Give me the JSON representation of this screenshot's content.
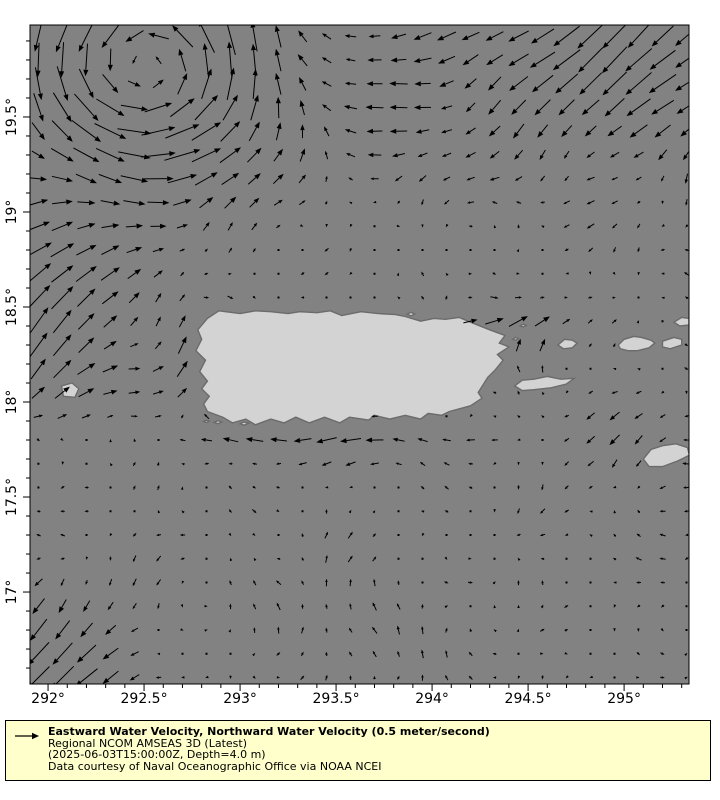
{
  "legend": {
    "title": "Eastward Water Velocity, Northward Water Velocity (0.5 meter/second)",
    "model": "Regional NCOM AMSEAS 3D (Latest)",
    "time_depth": "(2025-06-03T15:00:00Z, Depth=4.0 m)",
    "credit": "Data courtesy of Naval Oceanographic Office via NOAA NCEI"
  },
  "chart_data": {
    "type": "quiver_map",
    "description": "Vector field of eastward/northward water velocity around Puerto Rico and the Virgin Islands",
    "x_axis": {
      "ticks": [
        "292°",
        "292.5°",
        "293°",
        "293.5°",
        "294°",
        "294.5°",
        "295°"
      ],
      "tick_values": [
        292,
        292.5,
        293,
        293.5,
        294,
        294.5,
        295
      ],
      "minor_step": 0.1,
      "range": [
        291.906,
        295.338
      ]
    },
    "y_axis": {
      "ticks": [
        "17°",
        "17.5°",
        "18°",
        "18.5°",
        "19°",
        "19.5°"
      ],
      "tick_values": [
        17,
        17.5,
        18,
        18.5,
        19,
        19.5
      ],
      "minor_step": 0.1,
      "range": [
        16.516,
        19.984
      ]
    },
    "reference_vector": {
      "speed_ms": 0.5,
      "label": "0.5 meter/second"
    },
    "scale_px_per_ms": 46,
    "grid": {
      "lon_start": 291.95,
      "lat_start": 16.55,
      "step": 0.125,
      "nx": 28,
      "ny": 28
    },
    "colors": {
      "ocean": "#828282",
      "land": "#d3d3d3",
      "coastline": "#6b6b6b",
      "arrow": "#000000",
      "axes_border": "#000000",
      "legend_bg": "#ffffcc",
      "figure_bg": "#ffffff"
    },
    "islands": [
      {
        "name": "puerto-rico",
        "mask": true,
        "points": [
          [
            292.89,
            18.48
          ],
          [
            293.0,
            18.465
          ],
          [
            293.08,
            18.48
          ],
          [
            293.16,
            18.475
          ],
          [
            293.25,
            18.465
          ],
          [
            293.31,
            18.475
          ],
          [
            293.4,
            18.47
          ],
          [
            293.47,
            18.48
          ],
          [
            293.53,
            18.455
          ],
          [
            293.63,
            18.475
          ],
          [
            293.72,
            18.465
          ],
          [
            293.81,
            18.46
          ],
          [
            293.86,
            18.45
          ],
          [
            293.94,
            18.425
          ],
          [
            294.01,
            18.44
          ],
          [
            294.07,
            18.435
          ],
          [
            294.14,
            18.445
          ],
          [
            294.2,
            18.42
          ],
          [
            294.3,
            18.38
          ],
          [
            294.38,
            18.35
          ],
          [
            294.35,
            18.31
          ],
          [
            294.4,
            18.29
          ],
          [
            294.34,
            18.25
          ],
          [
            294.37,
            18.22
          ],
          [
            294.33,
            18.17
          ],
          [
            294.29,
            18.13
          ],
          [
            294.24,
            18.05
          ],
          [
            294.26,
            18.02
          ],
          [
            294.2,
            17.98
          ],
          [
            294.09,
            17.95
          ],
          [
            294.05,
            17.93
          ],
          [
            293.98,
            17.94
          ],
          [
            293.94,
            17.91
          ],
          [
            293.86,
            17.93
          ],
          [
            293.78,
            17.91
          ],
          [
            293.7,
            17.93
          ],
          [
            293.67,
            17.905
          ],
          [
            293.57,
            17.92
          ],
          [
            293.52,
            17.89
          ],
          [
            293.44,
            17.92
          ],
          [
            293.36,
            17.89
          ],
          [
            293.29,
            17.92
          ],
          [
            293.23,
            17.89
          ],
          [
            293.16,
            17.91
          ],
          [
            293.08,
            17.88
          ],
          [
            293.03,
            17.91
          ],
          [
            292.96,
            17.89
          ],
          [
            292.91,
            17.92
          ],
          [
            292.83,
            17.95
          ],
          [
            292.81,
            17.99
          ],
          [
            292.84,
            18.03
          ],
          [
            292.8,
            18.07
          ],
          [
            292.83,
            18.11
          ],
          [
            292.79,
            18.16
          ],
          [
            292.82,
            18.22
          ],
          [
            292.77,
            18.27
          ],
          [
            292.8,
            18.33
          ],
          [
            292.78,
            18.38
          ],
          [
            292.83,
            18.44
          ]
        ]
      },
      {
        "name": "vieques",
        "mask": true,
        "points": [
          [
            294.43,
            18.085
          ],
          [
            294.47,
            18.115
          ],
          [
            294.53,
            18.12
          ],
          [
            294.6,
            18.135
          ],
          [
            294.67,
            18.12
          ],
          [
            294.74,
            18.125
          ],
          [
            294.7,
            18.095
          ],
          [
            294.62,
            18.075
          ],
          [
            294.53,
            18.065
          ],
          [
            294.47,
            18.06
          ]
        ]
      },
      {
        "name": "culebra",
        "mask": true,
        "points": [
          [
            294.655,
            18.3
          ],
          [
            294.69,
            18.33
          ],
          [
            294.73,
            18.325
          ],
          [
            294.755,
            18.31
          ],
          [
            294.73,
            18.285
          ],
          [
            294.685,
            18.28
          ]
        ]
      },
      {
        "name": "mona",
        "mask": true,
        "points": [
          [
            292.07,
            18.085
          ],
          [
            292.125,
            18.1
          ],
          [
            292.16,
            18.07
          ],
          [
            292.14,
            18.025
          ],
          [
            292.08,
            18.03
          ]
        ]
      },
      {
        "name": "st-thomas",
        "mask": true,
        "points": [
          [
            294.97,
            18.3
          ],
          [
            295.0,
            18.33
          ],
          [
            295.05,
            18.345
          ],
          [
            295.09,
            18.34
          ],
          [
            295.14,
            18.325
          ],
          [
            295.16,
            18.31
          ],
          [
            295.13,
            18.285
          ],
          [
            295.07,
            18.27
          ],
          [
            295.02,
            18.27
          ],
          [
            294.98,
            18.28
          ]
        ]
      },
      {
        "name": "st-john",
        "mask": true,
        "points": [
          [
            295.2,
            18.32
          ],
          [
            295.26,
            18.34
          ],
          [
            295.3,
            18.33
          ],
          [
            295.3,
            18.3
          ],
          [
            295.24,
            18.28
          ],
          [
            295.2,
            18.29
          ]
        ]
      },
      {
        "name": "tortola",
        "mask": true,
        "points": [
          [
            295.26,
            18.42
          ],
          [
            295.3,
            18.445
          ],
          [
            295.338,
            18.44
          ],
          [
            295.338,
            18.405
          ],
          [
            295.29,
            18.4
          ]
        ]
      },
      {
        "name": "st-croix",
        "mask": true,
        "points": [
          [
            295.1,
            17.7
          ],
          [
            295.14,
            17.75
          ],
          [
            295.2,
            17.77
          ],
          [
            295.27,
            17.78
          ],
          [
            295.33,
            17.76
          ],
          [
            295.34,
            17.72
          ],
          [
            295.28,
            17.69
          ],
          [
            295.2,
            17.66
          ],
          [
            295.13,
            17.66
          ]
        ]
      },
      {
        "name": "islet-caja-de-muertos",
        "mask": false,
        "points": [
          [
            293.0,
            17.885
          ],
          [
            293.02,
            17.895
          ],
          [
            293.045,
            17.888
          ],
          [
            293.02,
            17.878
          ]
        ]
      },
      {
        "name": "islet-south-1",
        "mask": false,
        "points": [
          [
            292.865,
            17.893
          ],
          [
            292.885,
            17.902
          ],
          [
            292.905,
            17.895
          ],
          [
            292.885,
            17.886
          ]
        ]
      },
      {
        "name": "islet-south-2",
        "mask": false,
        "points": [
          [
            292.81,
            17.898
          ],
          [
            292.825,
            17.905
          ],
          [
            292.84,
            17.899
          ],
          [
            292.825,
            17.892
          ]
        ]
      },
      {
        "name": "islet-northeast-1",
        "mask": false,
        "points": [
          [
            294.46,
            18.4
          ],
          [
            294.475,
            18.41
          ],
          [
            294.49,
            18.403
          ],
          [
            294.475,
            18.395
          ]
        ]
      },
      {
        "name": "islet-northeast-2",
        "mask": false,
        "points": [
          [
            294.42,
            18.33
          ],
          [
            294.435,
            18.34
          ],
          [
            294.45,
            18.333
          ],
          [
            294.435,
            18.325
          ]
        ]
      },
      {
        "name": "islet-north-coast",
        "mask": false,
        "points": [
          [
            293.87,
            18.462
          ],
          [
            293.89,
            18.472
          ],
          [
            293.91,
            18.463
          ],
          [
            293.89,
            18.453
          ]
        ]
      }
    ],
    "flow_features": [
      {
        "name": "northwest-eddy",
        "type": "vortex",
        "center": [
          292.52,
          19.78
        ],
        "sigma": 0.42,
        "strength": 0.75,
        "rotation": "ccw"
      },
      {
        "name": "north-westward-band",
        "type": "gaussian",
        "center": [
          293.75,
          19.7
        ],
        "sx": 0.45,
        "sy": 0.55,
        "u": -0.32,
        "v": -0.02
      },
      {
        "name": "northeast-southwest-flow",
        "type": "gaussian",
        "center": [
          295.0,
          19.85
        ],
        "sx": 0.9,
        "sy": 0.6,
        "u": -0.55,
        "v": -0.48
      },
      {
        "name": "mona-passage-ne-jet",
        "type": "gaussian",
        "center": [
          291.9,
          18.55
        ],
        "sx": 0.45,
        "sy": 0.5,
        "u": 0.55,
        "v": 0.6
      },
      {
        "name": "mona-eastward-flow",
        "type": "gaussian",
        "center": [
          292.45,
          18.1
        ],
        "sx": 0.35,
        "sy": 0.22,
        "u": 0.3,
        "v": 0.05
      },
      {
        "name": "west-coast-northward",
        "type": "gaussian",
        "center": [
          292.7,
          18.25
        ],
        "sx": 0.12,
        "sy": 0.28,
        "u": 0.05,
        "v": 0.35
      },
      {
        "name": "south-coast-westward",
        "type": "gaussian",
        "center": [
          293.4,
          17.8
        ],
        "sx": 0.9,
        "sy": 0.13,
        "u": -0.38,
        "v": 0.0
      },
      {
        "name": "southwest-corner-flow",
        "type": "gaussian",
        "center": [
          291.9,
          16.5
        ],
        "sx": 0.55,
        "sy": 0.55,
        "u": -0.5,
        "v": -0.5
      },
      {
        "name": "south-center-north-patch",
        "type": "gaussian",
        "center": [
          293.6,
          16.85
        ],
        "sx": 0.45,
        "sy": 0.35,
        "u": 0.0,
        "v": 0.22
      },
      {
        "name": "east-tip-eastward",
        "type": "gaussian",
        "center": [
          294.35,
          18.43
        ],
        "sx": 0.3,
        "sy": 0.1,
        "u": 0.4,
        "v": 0.1
      },
      {
        "name": "vieques-north-flow",
        "type": "gaussian",
        "center": [
          294.52,
          18.33
        ],
        "sx": 0.18,
        "sy": 0.18,
        "u": 0.15,
        "v": 0.35
      },
      {
        "name": "east-south-drift",
        "type": "gaussian",
        "center": [
          294.9,
          17.8
        ],
        "sx": 0.45,
        "sy": 0.3,
        "u": -0.12,
        "v": -0.12
      },
      {
        "name": "right-mid-westward",
        "type": "gaussian",
        "center": [
          295.2,
          17.5
        ],
        "sx": 0.3,
        "sy": 0.3,
        "u": -0.15,
        "v": 0.0
      }
    ],
    "noise": {
      "terms": [
        {
          "target": "u",
          "amp": 0.055,
          "a": 3.1,
          "b": 7.3,
          "phase": 2.0
        },
        {
          "target": "u",
          "amp": 0.045,
          "a": 9.7,
          "b": -5.1,
          "phase": 0.0
        },
        {
          "target": "v",
          "amp": 0.055,
          "a": 4.3,
          "b": -6.1,
          "phase": 1.0
        },
        {
          "target": "v",
          "amp": 0.045,
          "a": 8.3,
          "b": 6.7,
          "phase": 0.5
        }
      ],
      "jitter": 0.05
    }
  }
}
